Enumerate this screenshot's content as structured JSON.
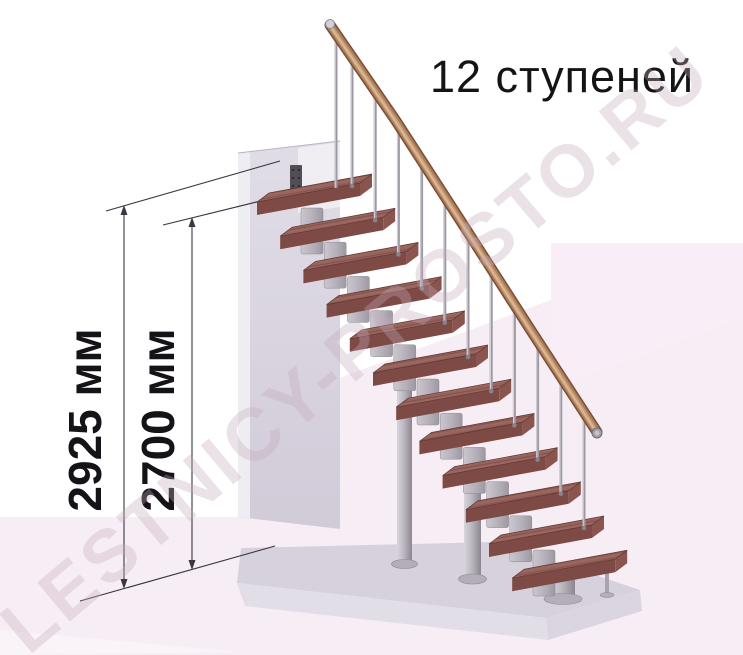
{
  "illustration": {
    "title": "12 ступеней",
    "watermark": "LESTNICY-PROSTO.RU",
    "dimensions": [
      {
        "id": "floor-to-upper-floor",
        "label": "2925 мм"
      },
      {
        "id": "floor-to-top-tread",
        "label": "2700 мм"
      }
    ],
    "stairs": {
      "steps_count": 12,
      "geometry": {
        "origin": [
          257,
          202
        ],
        "step_dx": 23.2,
        "step_dy": 34.2,
        "tread_len": 103,
        "tread_rise": 19,
        "tread_depth": 12,
        "tread_depth_rise": 9,
        "tread_thickness": 13,
        "baluster_offset": 95,
        "rail_start": [
          330,
          25
        ],
        "rail_end": [
          597,
          432
        ]
      }
    },
    "colors": {
      "tread_top": "#96625b",
      "tread_front": "#7e4a45",
      "tread_end": "#8a554e",
      "handrail": "#b58263",
      "metal_light": "#d8d5dc",
      "metal_dark": "#8b8690",
      "wall": "#d9d4df",
      "platform": "#d6d1dc",
      "floor_pink": "#f7eef5",
      "dimension_line": "#3a3742",
      "text": "#141414",
      "watermark_tint": "#c5aabd"
    }
  }
}
